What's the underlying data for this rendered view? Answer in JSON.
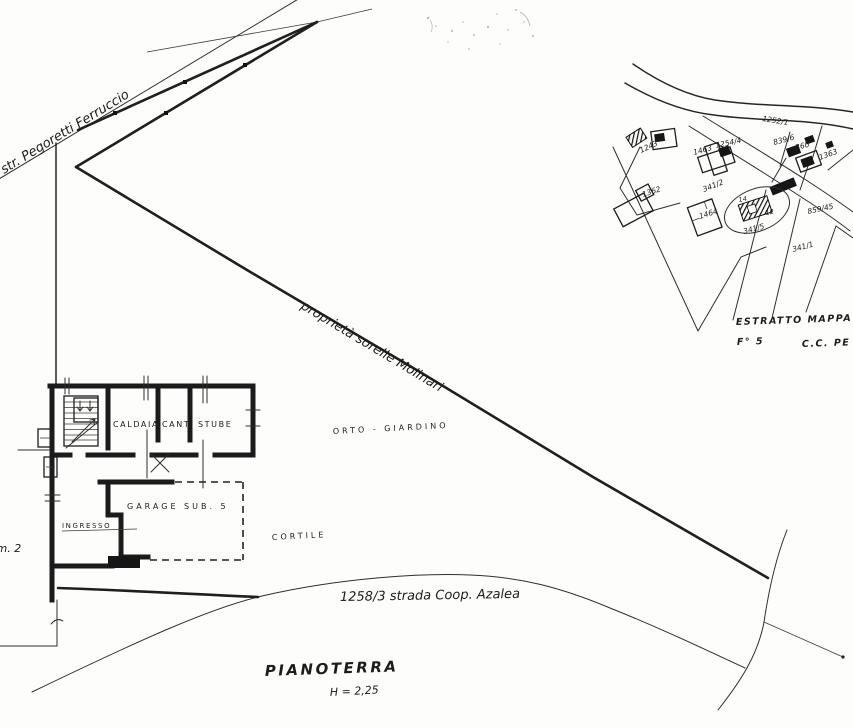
{
  "drawing": {
    "street_label": "str. Pegoretti Ferruccio",
    "property_label": "proprietà sorelle Molinari",
    "garden_label": "ORTO - GIARDINO",
    "courtyard_label": "CORTILE",
    "road_label": "1258/3 strada Coop. Azalea",
    "parcel_ref_label": "p.m. 2",
    "floor": {
      "title": "PIANOTERRA",
      "height_note": "H = 2,25"
    },
    "rooms": {
      "caldaia": "CALDAIA",
      "cantina": "CANT.",
      "stube": "STUBE",
      "garage": "GARAGE SUB. 5",
      "ingresso": "INGRESSO"
    }
  },
  "map_extract": {
    "title": "ESTRATTO MAPPA",
    "sheet": "F° 5",
    "commune": "C.C. PE",
    "parcels": [
      "1243",
      "1463",
      "1254/4",
      "839/6",
      "360",
      "1363",
      "1252/1",
      "1362",
      "341/2",
      "1464",
      "14",
      "12",
      "859/45",
      "341/5",
      "341/1"
    ]
  },
  "ink_color": "#1b1b1b",
  "paper_color": "#fdfdfc"
}
